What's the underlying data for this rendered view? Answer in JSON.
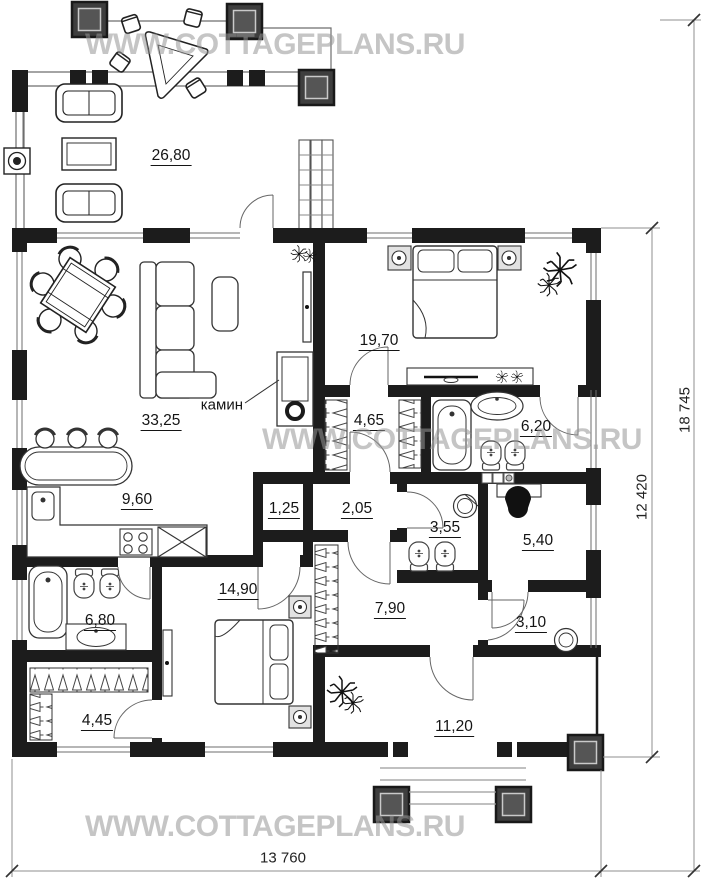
{
  "watermark": {
    "text": "WWW.COTTAGEPLANS.RU",
    "color": "#9b9b9b"
  },
  "plan": {
    "fireplace_label": "камин",
    "rooms": [
      {
        "id": "terrace",
        "area": "26,80",
        "cx": 171,
        "cy": 156
      },
      {
        "id": "bedroom-1",
        "area": "19,70",
        "cx": 379,
        "cy": 341
      },
      {
        "id": "living-room",
        "area": "33,25",
        "cx": 161,
        "cy": 421
      },
      {
        "id": "dressing-room",
        "area": "4,65",
        "cx": 369,
        "cy": 421
      },
      {
        "id": "bathroom-1",
        "area": "6,20",
        "cx": 536,
        "cy": 427
      },
      {
        "id": "kitchen",
        "area": "9,60",
        "cx": 137,
        "cy": 500
      },
      {
        "id": "pantry",
        "area": "1,25",
        "cx": 284,
        "cy": 509
      },
      {
        "id": "hallway",
        "area": "2,05",
        "cx": 357,
        "cy": 509
      },
      {
        "id": "wc",
        "area": "3,55",
        "cx": 445,
        "cy": 528
      },
      {
        "id": "study",
        "area": "5,40",
        "cx": 538,
        "cy": 541
      },
      {
        "id": "bedroom-2",
        "area": "14,90",
        "cx": 238,
        "cy": 590
      },
      {
        "id": "bathroom-2",
        "area": "6,80",
        "cx": 100,
        "cy": 621
      },
      {
        "id": "entry-hall",
        "area": "7,90",
        "cx": 390,
        "cy": 609
      },
      {
        "id": "vestibule",
        "area": "3,10",
        "cx": 531,
        "cy": 623
      },
      {
        "id": "wardrobe",
        "area": "4,45",
        "cx": 97,
        "cy": 721
      },
      {
        "id": "porch",
        "area": "11,20",
        "cx": 454,
        "cy": 727
      }
    ],
    "dimensions": {
      "bottom": "13 760",
      "right_inner": "12 420",
      "right_outer": "18 745"
    },
    "colors": {
      "wall": "#1c1c1c",
      "column": "#3e3e3e"
    }
  }
}
